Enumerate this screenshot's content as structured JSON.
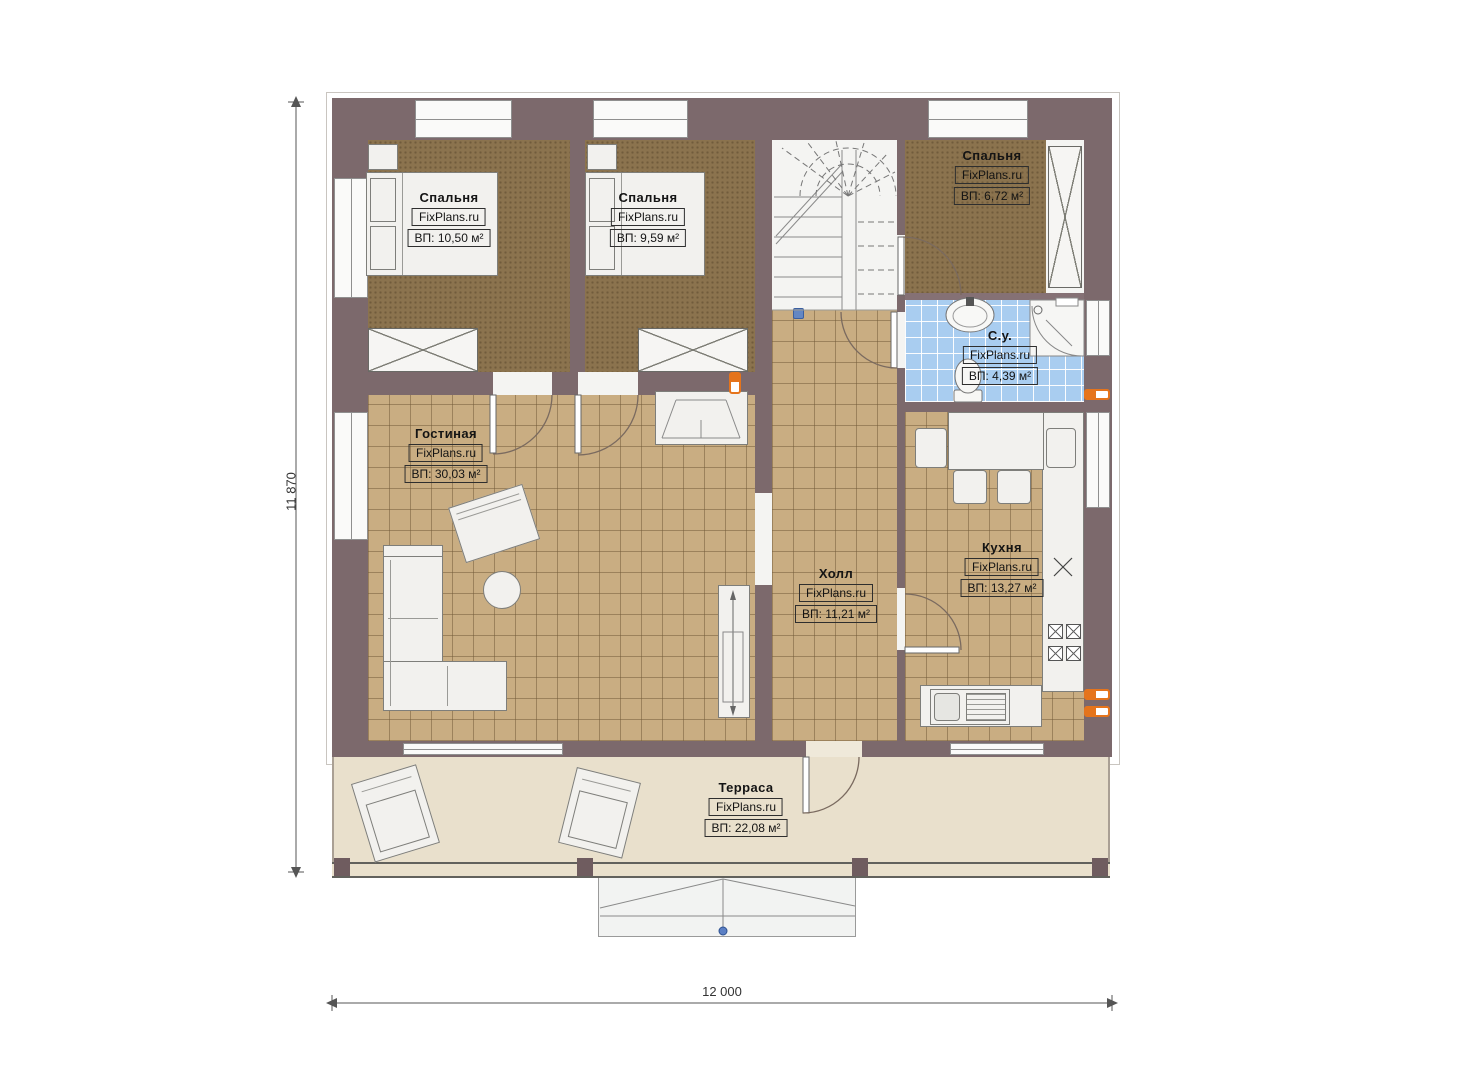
{
  "watermark": "FixPlans.ru",
  "dimensions": {
    "overall_width_mm": "12 000",
    "overall_height_mm": "11 870"
  },
  "rooms": {
    "bedroom1": {
      "name": "Спальня",
      "area": "ВП: 10,50 м²"
    },
    "bedroom2": {
      "name": "Спальня",
      "area": "ВП: 9,59 м²"
    },
    "bedroom3": {
      "name": "Спальня",
      "area": "ВП: 6,72 м²"
    },
    "bathroom": {
      "name": "С.у.",
      "area": "ВП: 4,39 м²"
    },
    "living_room": {
      "name": "Гостиная",
      "area": "ВП: 30,03 м²"
    },
    "hall": {
      "name": "Холл",
      "area": "ВП: 11,21 м²"
    },
    "kitchen": {
      "name": "Кухня",
      "area": "ВП: 13,27 м²"
    },
    "terrace": {
      "name": "Терраса",
      "area": "ВП: 22,08 м²"
    }
  },
  "colors": {
    "wall": "#7c696c",
    "bedroom_floor": "#8b734e",
    "tile_floor": "#c9ad82",
    "bathroom_floor": "#a9cdf0",
    "terrace_floor": "#e9e0cc",
    "radiator_accent": "#e5741c",
    "marker_blue": "#6487c3"
  }
}
